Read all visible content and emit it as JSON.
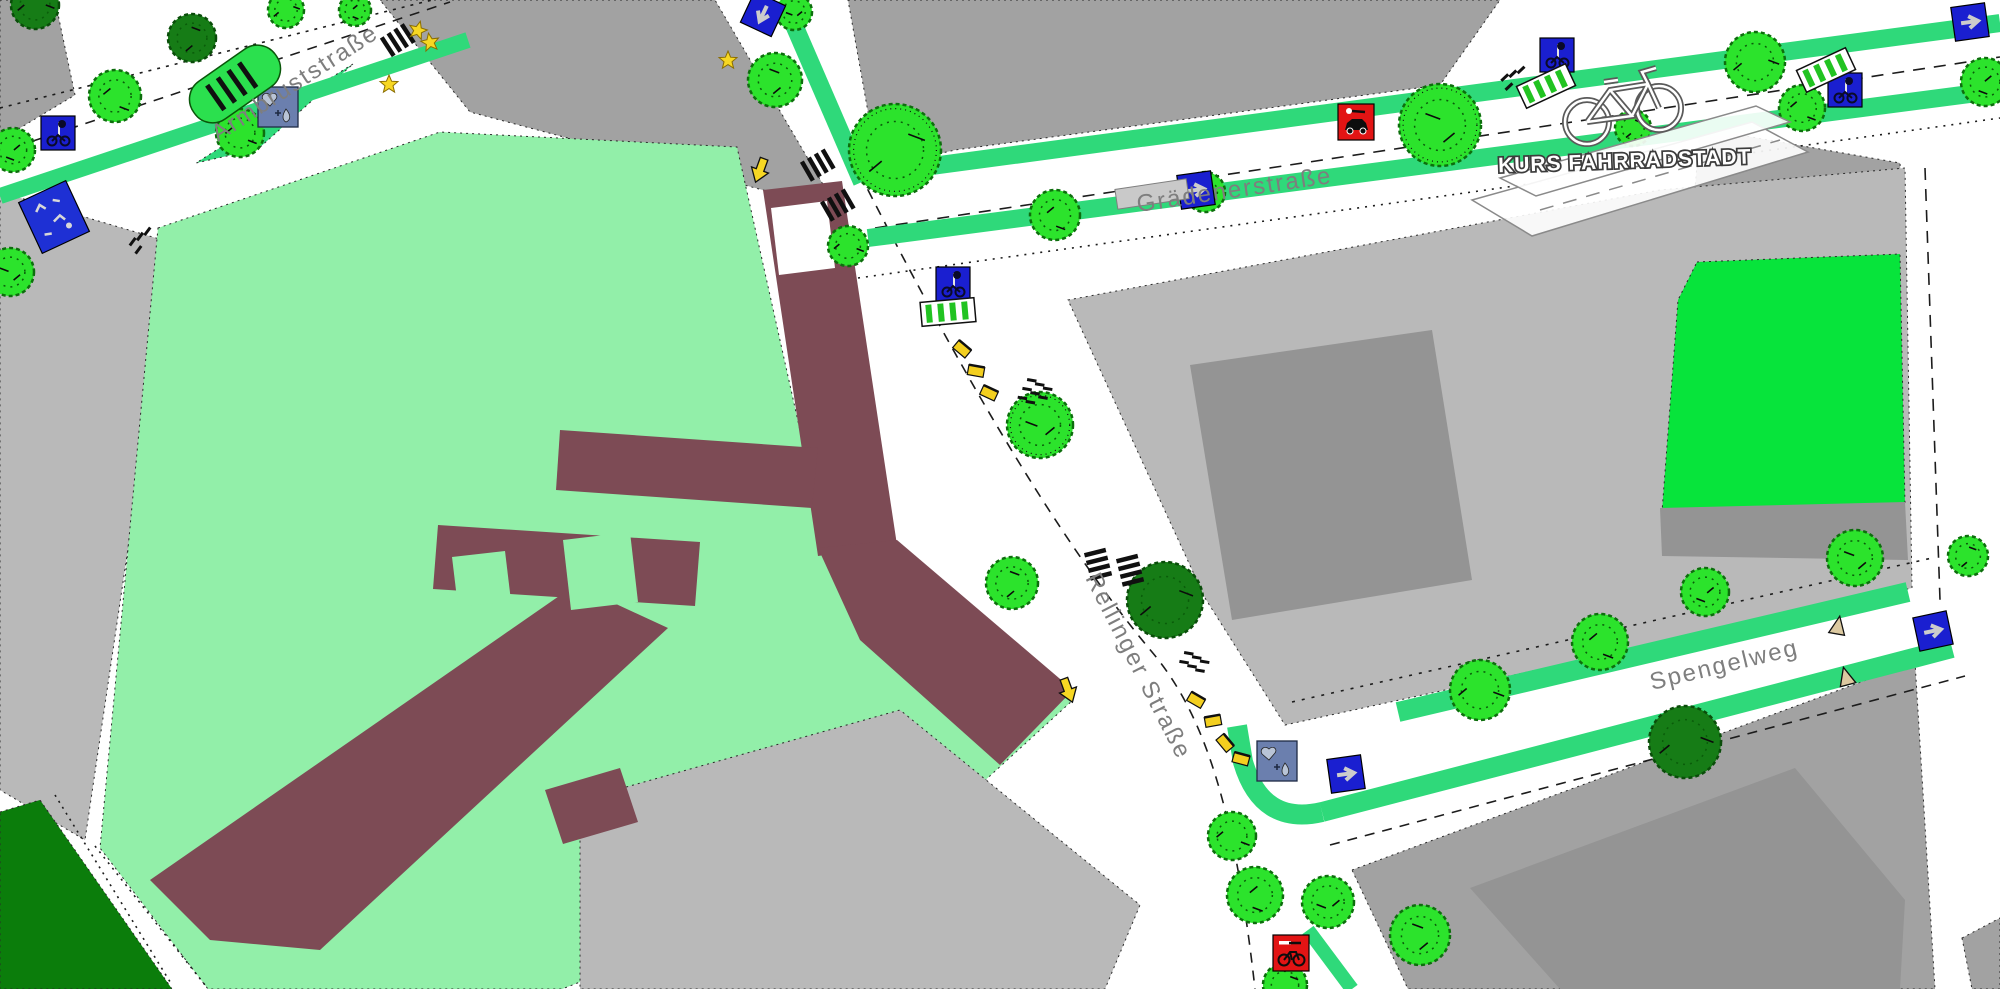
{
  "logo": {
    "text": "KURS FAHRRADSTADT"
  },
  "streets": [
    {
      "id": "armbruststrasse",
      "label": "Armbruststraße",
      "x": 218,
      "y": 142,
      "rotation": -33,
      "font_size": 24
    },
    {
      "id": "graedenerstrasse",
      "label": "Grädenerstraße",
      "x": 1138,
      "y": 212,
      "rotation": -8.5,
      "font_size": 24
    },
    {
      "id": "rellinger-strasse",
      "label": "Rellinger Straße",
      "x": 1085,
      "y": 578,
      "rotation": 63,
      "font_size": 24
    },
    {
      "id": "spengelweg",
      "label": "Spengelweg",
      "x": 1652,
      "y": 690,
      "rotation": -13.5,
      "font_size": 24
    }
  ],
  "colors": {
    "street_white": "#ffffff",
    "block_gray": "#a2a2a2",
    "block_gray_light": "#b9b9b9",
    "building_gray_dark": "#949494",
    "grounds_mint": "#92efa9",
    "park_green": "#07e43b",
    "forest_green": "#0b7d0b",
    "tree_green": "#2ce32c",
    "tree_dark": "#167c16",
    "lane_green": "#2fd97a",
    "building_maroon": "#7d4b55",
    "sign_blue": "#1a1fd0",
    "sign_slate": "#6b7fae",
    "sign_red": "#e21414",
    "marker_yellow": "#f7d723"
  },
  "areas": [
    {
      "name": "city-block",
      "fill": "block_gray",
      "pts": [
        [
          0,
          0
        ],
        [
          55,
          0
        ],
        [
          75,
          95
        ],
        [
          0,
          140
        ]
      ]
    },
    {
      "name": "city-block",
      "fill": "block_gray",
      "pts": [
        [
          380,
          0
        ],
        [
          715,
          0
        ],
        [
          838,
          210
        ],
        [
          470,
          112
        ]
      ]
    },
    {
      "name": "city-block",
      "fill": "block_gray",
      "pts": [
        [
          848,
          0
        ],
        [
          1500,
          0
        ],
        [
          1440,
          85
        ],
        [
          955,
          150
        ],
        [
          878,
          168
        ]
      ]
    },
    {
      "name": "city-block",
      "fill": "block_gray",
      "pts": [
        [
          1700,
          128
        ],
        [
          1900,
          163
        ],
        [
          1905,
          255
        ],
        [
          1690,
          250
        ]
      ]
    },
    {
      "name": "city-block",
      "fill": "block_gray_light",
      "pts": [
        [
          1068,
          300
        ],
        [
          1660,
          190
        ],
        [
          1905,
          168
        ],
        [
          1912,
          588
        ],
        [
          1285,
          725
        ],
        [
          1205,
          598
        ]
      ]
    },
    {
      "name": "park-area",
      "fill": "park_green",
      "pts": [
        [
          1697,
          262
        ],
        [
          1900,
          254
        ],
        [
          1905,
          505
        ],
        [
          1662,
          512
        ],
        [
          1678,
          300
        ]
      ]
    },
    {
      "name": "building",
      "fill": "building_gray_dark",
      "pts": [
        [
          1190,
          365
        ],
        [
          1432,
          330
        ],
        [
          1472,
          580
        ],
        [
          1232,
          620
        ]
      ]
    },
    {
      "name": "building",
      "fill": "building_gray_dark",
      "pts": [
        [
          1660,
          508
        ],
        [
          1905,
          502
        ],
        [
          1908,
          560
        ],
        [
          1662,
          556
        ]
      ]
    },
    {
      "name": "city-block",
      "fill": "block_gray_light",
      "pts": [
        [
          0,
          192
        ],
        [
          173,
          243
        ],
        [
          85,
          840
        ],
        [
          0,
          790
        ]
      ]
    },
    {
      "name": "school-grounds",
      "fill": "grounds_mint",
      "pts": [
        [
          158,
          228
        ],
        [
          440,
          132
        ],
        [
          737,
          147
        ],
        [
          828,
          556
        ],
        [
          1073,
          700
        ],
        [
          900,
          858
        ],
        [
          562,
          989
        ],
        [
          208,
          989
        ],
        [
          100,
          848
        ]
      ]
    },
    {
      "name": "green-verge",
      "fill": "lane_green",
      "pts": [
        [
          353,
          64
        ],
        [
          300,
          97
        ],
        [
          196,
          163
        ],
        [
          258,
          149
        ]
      ]
    },
    {
      "name": "city-block",
      "fill": "block_gray_light",
      "pts": [
        [
          580,
          800
        ],
        [
          900,
          710
        ],
        [
          1140,
          905
        ],
        [
          1105,
          989
        ],
        [
          580,
          989
        ]
      ]
    },
    {
      "name": "city-block",
      "fill": "block_gray",
      "pts": [
        [
          1352,
          870
        ],
        [
          1915,
          662
        ],
        [
          1935,
          989
        ],
        [
          1408,
          989
        ]
      ]
    },
    {
      "name": "building",
      "fill": "building_gray_dark",
      "pts": [
        [
          1470,
          888
        ],
        [
          1795,
          768
        ],
        [
          1905,
          900
        ],
        [
          1900,
          989
        ],
        [
          1560,
          989
        ]
      ]
    },
    {
      "name": "city-block",
      "fill": "block_gray",
      "pts": [
        [
          1962,
          938
        ],
        [
          2000,
          918
        ],
        [
          2000,
          989
        ],
        [
          1972,
          989
        ]
      ]
    },
    {
      "name": "forest-area",
      "fill": "forest_green",
      "pts": [
        [
          0,
          812
        ],
        [
          40,
          800
        ],
        [
          172,
          989
        ],
        [
          0,
          989
        ]
      ]
    },
    {
      "name": "school-building",
      "fill": "building_maroon",
      "pts": [
        [
          763,
          190
        ],
        [
          842,
          181
        ],
        [
          897,
          545
        ],
        [
          818,
          556
        ]
      ]
    },
    {
      "name": "school-building",
      "fill": "building_maroon",
      "pts": [
        [
          818,
          548
        ],
        [
          897,
          540
        ],
        [
          1073,
          690
        ],
        [
          1000,
          765
        ],
        [
          860,
          640
        ]
      ]
    },
    {
      "name": "school-building",
      "fill": "building_maroon",
      "pts": [
        [
          560,
          430
        ],
        [
          818,
          448
        ],
        [
          812,
          508
        ],
        [
          556,
          490
        ]
      ]
    },
    {
      "name": "school-building",
      "fill": "building_maroon",
      "pts": [
        [
          438,
          525
        ],
        [
          700,
          542
        ],
        [
          695,
          606
        ],
        [
          433,
          589
        ]
      ]
    },
    {
      "name": "school-building",
      "fill": "building_maroon",
      "pts": [
        [
          575,
          585
        ],
        [
          668,
          628
        ],
        [
          320,
          950
        ],
        [
          210,
          940
        ],
        [
          150,
          880
        ]
      ]
    },
    {
      "name": "school-building",
      "fill": "building_maroon",
      "pts": [
        [
          545,
          790
        ],
        [
          620,
          768
        ],
        [
          638,
          822
        ],
        [
          563,
          844
        ]
      ]
    },
    {
      "name": "courtyard",
      "fill": "street_white",
      "pts": [
        [
          771,
          208
        ],
        [
          827,
          201
        ],
        [
          835,
          268
        ],
        [
          779,
          275
        ]
      ]
    },
    {
      "name": "courtyard",
      "fill": "grounds_mint",
      "pts": [
        [
          563,
          540
        ],
        [
          630,
          532
        ],
        [
          638,
          602
        ],
        [
          571,
          610
        ]
      ]
    },
    {
      "name": "courtyard",
      "fill": "grounds_mint",
      "pts": [
        [
          452,
          557
        ],
        [
          505,
          551
        ],
        [
          511,
          601
        ],
        [
          458,
          607
        ]
      ]
    }
  ],
  "lanes": [
    {
      "line": [
        0,
        196,
        468,
        40
      ],
      "w": 16
    },
    {
      "line": [
        791,
        18,
        862,
        182
      ],
      "w": 18
    },
    {
      "line": [
        902,
        170,
        2000,
        23
      ],
      "w": 18
    },
    {
      "line": [
        868,
        238,
        2000,
        90
      ],
      "w": 18
    },
    {
      "line": [
        1398,
        712,
        1908,
        592
      ],
      "w": 20
    },
    {
      "line": [
        1322,
        812,
        1952,
        648
      ],
      "w": 20
    },
    {
      "line": [
        1308,
        930,
        1352,
        989
      ],
      "w": 14
    },
    {
      "path": "M 1322,812 Q 1262,826 1243,762 L 1237,726",
      "w": 20
    }
  ],
  "road_lines": [
    {
      "line": [
        0,
        152,
        450,
        2
      ],
      "dash": "10,8"
    },
    {
      "line": [
        0,
        108,
        432,
        0
      ],
      "dash": "3,6"
    },
    {
      "line": [
        788,
        8,
        868,
        190
      ],
      "dash": "10,8"
    },
    {
      "path": "M 868,190 C 950,350 1050,530 1152,652 C 1205,715 1235,810 1255,989",
      "dash": "10,8"
    },
    {
      "line": [
        875,
        228,
        2000,
        57
      ],
      "dash": "12,9"
    },
    {
      "line": [
        858,
        278,
        2000,
        118
      ],
      "dash": "2,6"
    },
    {
      "line": [
        1292,
        702,
        1932,
        558
      ],
      "dash": "3,7"
    },
    {
      "line": [
        1330,
        845,
        1965,
        676
      ],
      "dash": "10,8"
    },
    {
      "line": [
        1925,
        168,
        1940,
        600
      ],
      "dash": "12,9"
    },
    {
      "line": [
        55,
        795,
        172,
        985
      ],
      "dash": "2,5"
    },
    {
      "line": [
        95,
        846,
        205,
        985
      ],
      "dash": "2,5"
    }
  ],
  "trees": [
    {
      "x": 35,
      "y": 5,
      "r": 24,
      "v": "d"
    },
    {
      "x": 115,
      "y": 96,
      "r": 26,
      "v": "b"
    },
    {
      "x": 13,
      "y": 150,
      "r": 22,
      "v": "b"
    },
    {
      "x": 10,
      "y": 272,
      "r": 24,
      "v": "b"
    },
    {
      "x": 192,
      "y": 38,
      "r": 24,
      "v": "d"
    },
    {
      "x": 286,
      "y": 10,
      "r": 18,
      "v": "b"
    },
    {
      "x": 240,
      "y": 133,
      "r": 24,
      "v": "b"
    },
    {
      "x": 355,
      "y": 10,
      "r": 16,
      "v": "b"
    },
    {
      "x": 794,
      "y": 12,
      "r": 18,
      "v": "b"
    },
    {
      "x": 775,
      "y": 80,
      "r": 27,
      "v": "b"
    },
    {
      "x": 895,
      "y": 150,
      "r": 46,
      "v": "h"
    },
    {
      "x": 848,
      "y": 246,
      "r": 20,
      "v": "b"
    },
    {
      "x": 1055,
      "y": 215,
      "r": 25,
      "v": "b"
    },
    {
      "x": 1205,
      "y": 192,
      "r": 20,
      "v": "b"
    },
    {
      "x": 1440,
      "y": 125,
      "r": 41,
      "v": "h"
    },
    {
      "x": 1633,
      "y": 128,
      "r": 18,
      "v": "b"
    },
    {
      "x": 1755,
      "y": 62,
      "r": 30,
      "v": "b"
    },
    {
      "x": 1802,
      "y": 108,
      "r": 23,
      "v": "b"
    },
    {
      "x": 1985,
      "y": 82,
      "r": 24,
      "v": "b"
    },
    {
      "x": 1040,
      "y": 425,
      "r": 33,
      "v": "h"
    },
    {
      "x": 1012,
      "y": 583,
      "r": 26,
      "v": "b"
    },
    {
      "x": 1165,
      "y": 600,
      "r": 38,
      "v": "d"
    },
    {
      "x": 1232,
      "y": 836,
      "r": 24,
      "v": "b"
    },
    {
      "x": 1255,
      "y": 895,
      "r": 28,
      "v": "b"
    },
    {
      "x": 1328,
      "y": 902,
      "r": 26,
      "v": "b"
    },
    {
      "x": 1420,
      "y": 935,
      "r": 30,
      "v": "b"
    },
    {
      "x": 1285,
      "y": 985,
      "r": 22,
      "v": "b"
    },
    {
      "x": 1480,
      "y": 690,
      "r": 30,
      "v": "b"
    },
    {
      "x": 1600,
      "y": 642,
      "r": 28,
      "v": "b"
    },
    {
      "x": 1705,
      "y": 592,
      "r": 24,
      "v": "b"
    },
    {
      "x": 1855,
      "y": 558,
      "r": 28,
      "v": "b"
    },
    {
      "x": 1968,
      "y": 556,
      "r": 20,
      "v": "b"
    },
    {
      "x": 1685,
      "y": 742,
      "r": 36,
      "v": "d"
    }
  ],
  "icons": [
    {
      "t": "oneway",
      "name": "one-way-sign-icon",
      "x": 763,
      "y": 14,
      "r": 115
    },
    {
      "t": "oneway",
      "name": "one-way-sign-icon",
      "x": 1196,
      "y": 190,
      "r": -8
    },
    {
      "t": "oneway",
      "name": "one-way-sign-icon",
      "x": 1346,
      "y": 774,
      "r": -8
    },
    {
      "t": "oneway",
      "name": "one-way-sign-icon",
      "x": 1933,
      "y": 631,
      "r": -12
    },
    {
      "t": "oneway",
      "name": "one-way-sign-icon",
      "x": 1970,
      "y": 22,
      "r": -8
    },
    {
      "t": "bikesignal",
      "name": "bike-signal-sign-icon",
      "x": 58,
      "y": 133,
      "r": 0
    },
    {
      "t": "bikesignal",
      "name": "bike-signal-sign-icon",
      "x": 953,
      "y": 284,
      "r": 0
    },
    {
      "t": "bikesignal",
      "name": "bike-signal-sign-icon",
      "x": 1557,
      "y": 55,
      "r": 0
    },
    {
      "t": "bikesignal",
      "name": "bike-signal-sign-icon",
      "x": 1845,
      "y": 90,
      "r": 0
    },
    {
      "t": "redcar",
      "name": "no-parking-sign-icon",
      "x": 1356,
      "y": 122,
      "r": 0
    },
    {
      "t": "redbike",
      "name": "bike-marker-sign-icon",
      "x": 1291,
      "y": 953,
      "r": 0
    },
    {
      "t": "greening",
      "name": "greening-sign-icon",
      "x": 278,
      "y": 107,
      "r": 0
    },
    {
      "t": "greening",
      "name": "greening-sign-icon",
      "x": 1277,
      "y": 761,
      "r": 0
    },
    {
      "t": "playarea",
      "name": "play-area-icon",
      "x": 54,
      "y": 217,
      "r": -25
    },
    {
      "t": "parklet",
      "name": "parklet",
      "x": 235,
      "y": 84,
      "r": -35
    },
    {
      "t": "busstop",
      "name": "bus-stop",
      "x": 1152,
      "y": 194,
      "r": -8.5
    },
    {
      "t": "rack",
      "name": "bike-rack",
      "x": 948,
      "y": 312,
      "r": -5
    },
    {
      "t": "rack",
      "name": "bike-rack",
      "x": 1546,
      "y": 86,
      "r": -25
    },
    {
      "t": "rack",
      "name": "bike-rack",
      "x": 1826,
      "y": 70,
      "r": -25
    },
    {
      "t": "crosswalk",
      "name": "crosswalk",
      "x": 398,
      "y": 40,
      "r": 57
    },
    {
      "t": "crosswalk",
      "name": "crosswalk",
      "x": 818,
      "y": 165,
      "r": 60
    },
    {
      "t": "crosswalk",
      "name": "crosswalk",
      "x": 838,
      "y": 205,
      "r": 60
    },
    {
      "t": "crosswalk",
      "name": "crosswalk",
      "x": 1098,
      "y": 564,
      "r": -14
    },
    {
      "t": "crosswalk",
      "name": "crosswalk",
      "x": 1130,
      "y": 570,
      "r": -14
    },
    {
      "t": "dashgroup",
      "name": "road-dashes",
      "n": 4,
      "x": 1510,
      "y": 90,
      "r": -25
    },
    {
      "t": "dashgroup",
      "name": "road-dashes",
      "n": 4,
      "x": 140,
      "y": 253,
      "r": -35
    },
    {
      "t": "dashgroup",
      "name": "road-dashes",
      "n": 8,
      "x": 1025,
      "y": 392,
      "r": 28
    },
    {
      "t": "dashgroup",
      "name": "road-dashes",
      "n": 6,
      "x": 1182,
      "y": 665,
      "r": 28
    },
    {
      "t": "star",
      "name": "star-marker",
      "x": 389,
      "y": 84,
      "r": 0
    },
    {
      "t": "star",
      "name": "star-marker",
      "x": 418,
      "y": 30,
      "r": 15
    },
    {
      "t": "star",
      "name": "star-marker",
      "x": 430,
      "y": 42,
      "r": -10
    },
    {
      "t": "star",
      "name": "star-marker",
      "x": 728,
      "y": 60,
      "r": 0
    },
    {
      "t": "yarrow",
      "name": "arrow-marker",
      "x": 760,
      "y": 170,
      "r": 200
    },
    {
      "t": "yarrow",
      "name": "arrow-marker",
      "x": 1068,
      "y": 690,
      "r": 160
    },
    {
      "t": "bench",
      "name": "bench",
      "x": 962,
      "y": 349,
      "r": 40
    },
    {
      "t": "bench",
      "name": "bench",
      "x": 976,
      "y": 371,
      "r": 10
    },
    {
      "t": "bench",
      "name": "bench",
      "x": 989,
      "y": 393,
      "r": 25
    },
    {
      "t": "bench",
      "name": "bench",
      "x": 1196,
      "y": 700,
      "r": 30
    },
    {
      "t": "bench",
      "name": "bench",
      "x": 1213,
      "y": 721,
      "r": -10
    },
    {
      "t": "bench",
      "name": "bench",
      "x": 1225,
      "y": 743,
      "r": 50
    },
    {
      "t": "bench",
      "name": "bench",
      "x": 1241,
      "y": 759,
      "r": 15
    },
    {
      "t": "bollard",
      "name": "bollard",
      "x": 1838,
      "y": 626,
      "r": 10
    },
    {
      "t": "bollard",
      "name": "bollard",
      "x": 1846,
      "y": 677,
      "r": -15
    }
  ]
}
